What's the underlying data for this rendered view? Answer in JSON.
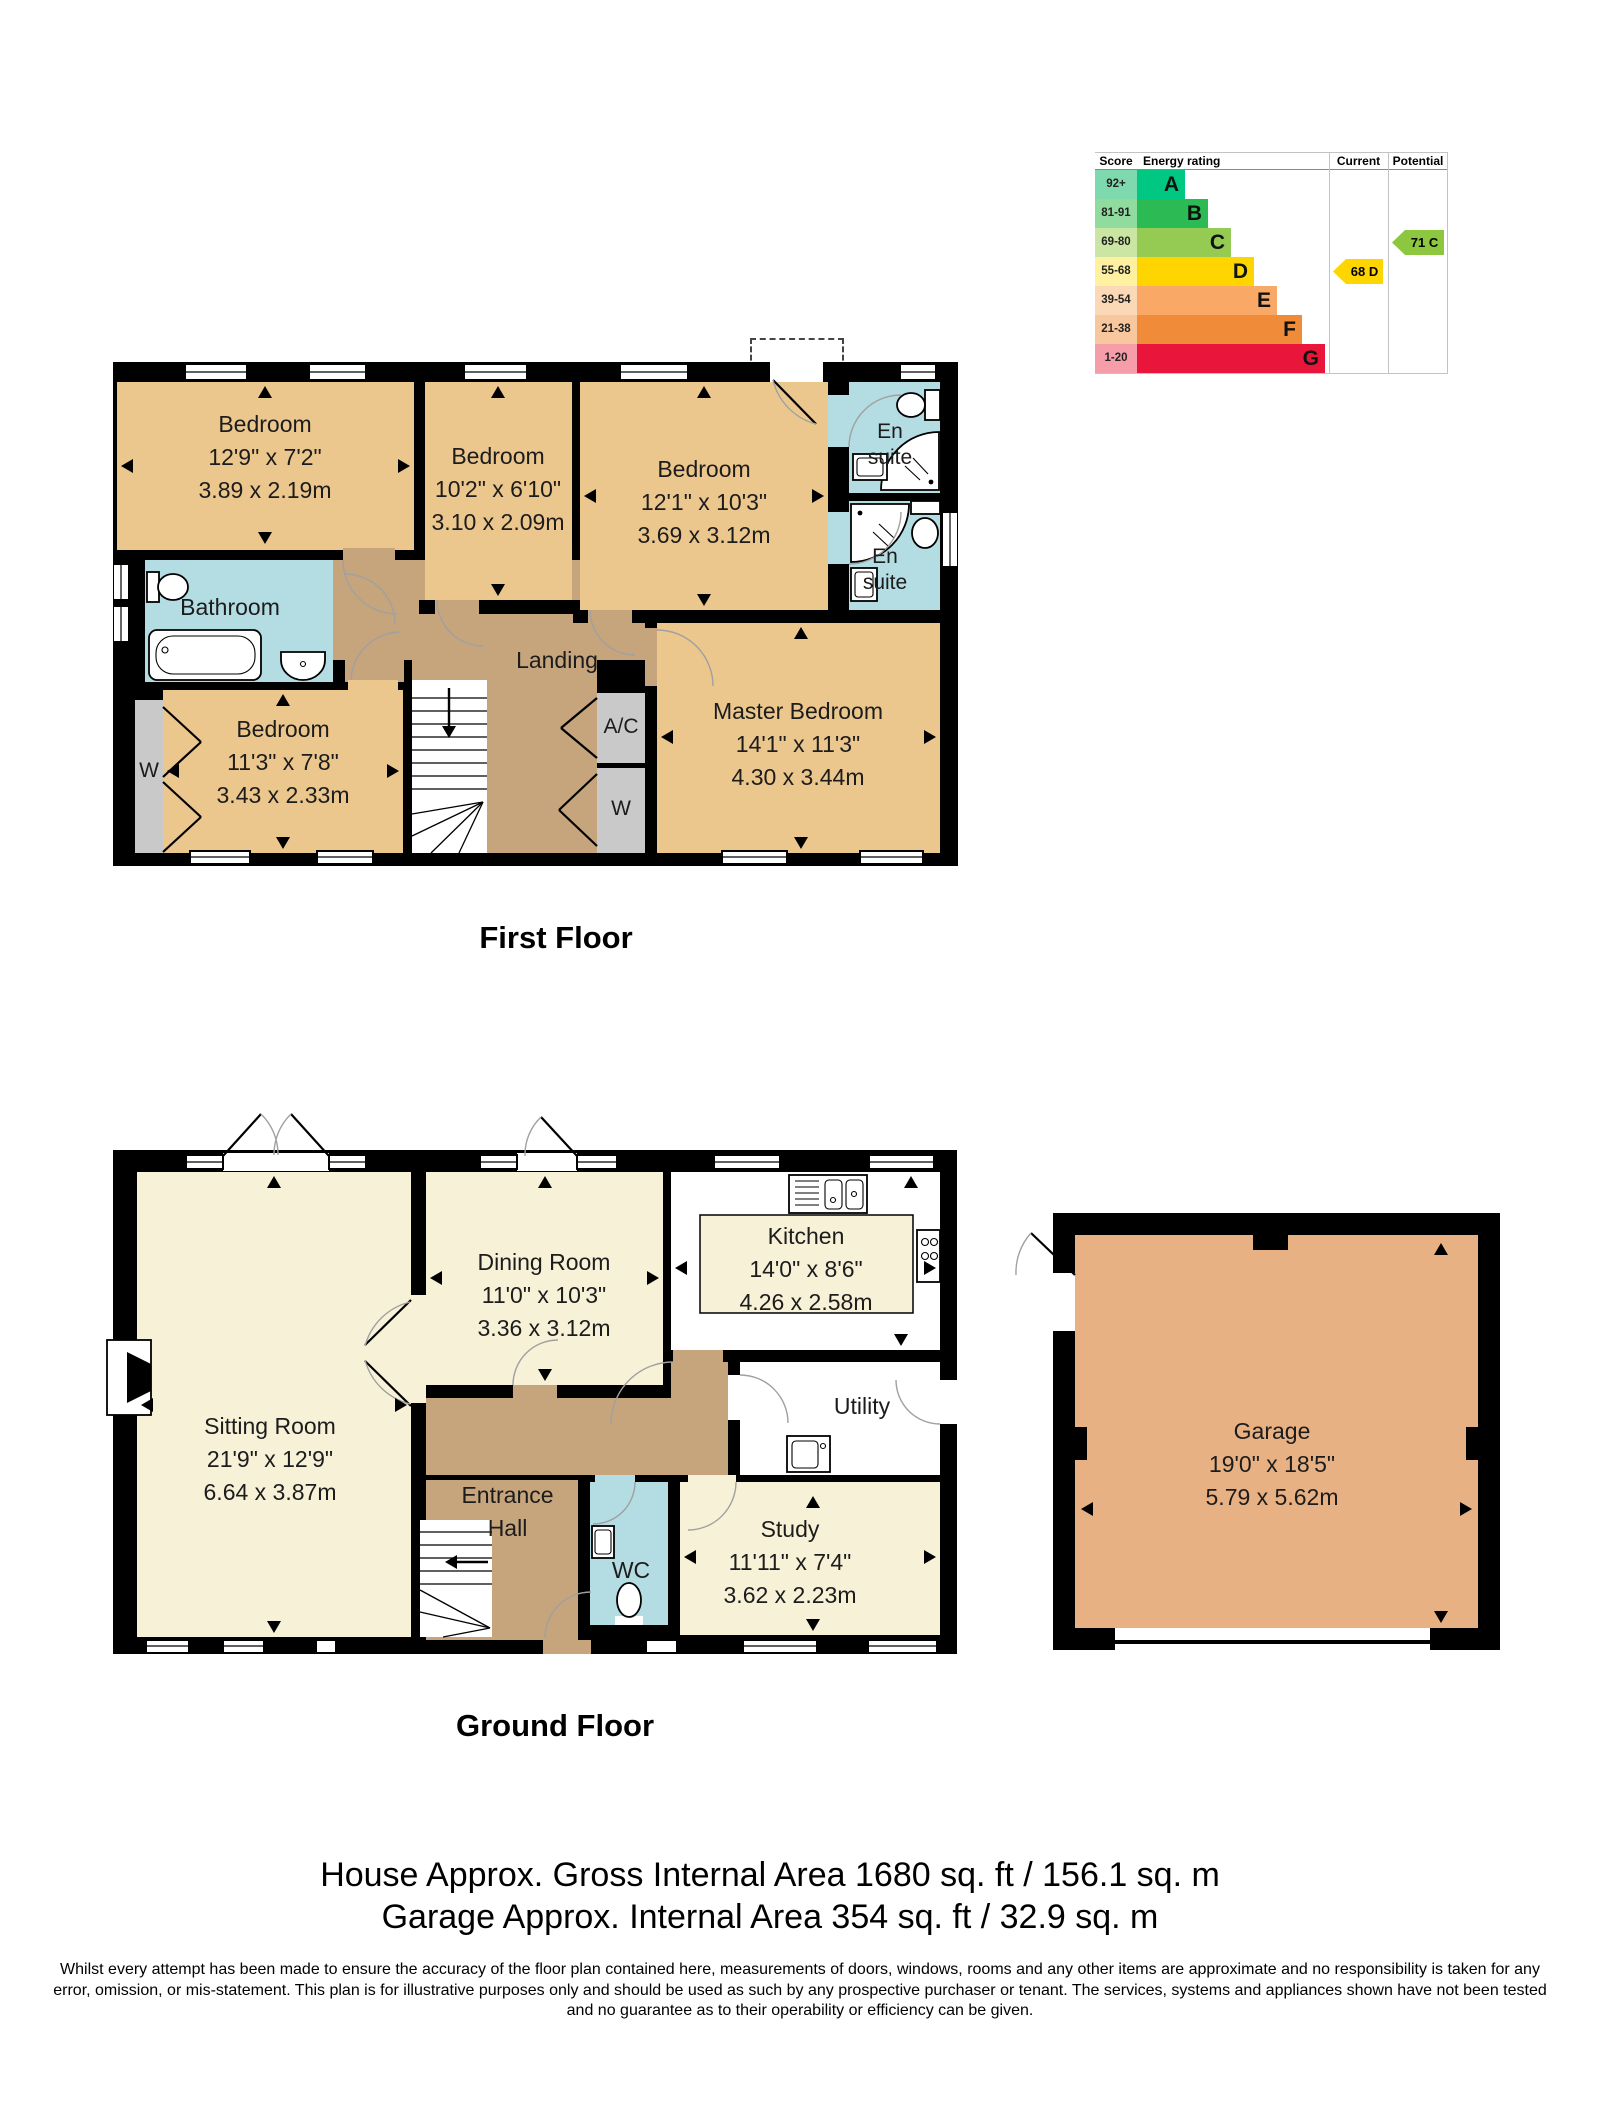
{
  "palette": {
    "wall": "#000000",
    "tan": "#ebc78e",
    "brown": "#c6a57d",
    "cream": "#f7f1d7",
    "blue": "#b4dce3",
    "gray": "#c9c9c9",
    "garage": "#e8b184"
  },
  "epc": {
    "headers": {
      "score": "Score",
      "rating": "Energy rating",
      "current": "Current",
      "potential": "Potential"
    },
    "bands": [
      {
        "score": "92+",
        "letter": "A",
        "color": "#00c781",
        "swatch": "#7fd9ae",
        "width": 48
      },
      {
        "score": "81-91",
        "letter": "B",
        "color": "#2cba54",
        "swatch": "#90db9e",
        "width": 71
      },
      {
        "score": "69-80",
        "letter": "C",
        "color": "#95ca53",
        "swatch": "#cbe6a3",
        "width": 94
      },
      {
        "score": "55-68",
        "letter": "D",
        "color": "#ffd500",
        "swatch": "#fff1a0",
        "width": 117
      },
      {
        "score": "39-54",
        "letter": "E",
        "color": "#f9a965",
        "swatch": "#fcd9b6",
        "width": 140
      },
      {
        "score": "21-38",
        "letter": "F",
        "color": "#ef8b39",
        "swatch": "#f8c79e",
        "width": 165
      },
      {
        "score": "1-20",
        "letter": "G",
        "color": "#e9153b",
        "swatch": "#f59ea9",
        "width": 188
      }
    ],
    "current": {
      "label": "68 D",
      "color": "#ffd500",
      "row": 3
    },
    "potential": {
      "label": "71 C",
      "color": "#8dc63f",
      "row": 2
    }
  },
  "first_floor": {
    "title": "First Floor",
    "rooms": {
      "bedroom1": {
        "name": "Bedroom",
        "imperial": "12'9\" x 7'2\"",
        "metric": "3.89 x 2.19m"
      },
      "bedroom2": {
        "name": "Bedroom",
        "imperial": "10'2\" x 6'10\"",
        "metric": "3.10 x 2.09m"
      },
      "bedroom3": {
        "name": "Bedroom",
        "imperial": "12'1\" x 10'3\"",
        "metric": "3.69 x 3.12m"
      },
      "ensuite1": {
        "name": "En suite"
      },
      "ensuite2": {
        "name": "En suite"
      },
      "bathroom": {
        "name": "Bathroom"
      },
      "landing": {
        "name": "Landing"
      },
      "bedroom4": {
        "name": "Bedroom",
        "imperial": "11'3\" x 7'8\"",
        "metric": "3.43 x 2.33m"
      },
      "master": {
        "name": "Master Bedroom",
        "imperial": "14'1\" x 11'3\"",
        "metric": "4.30 x 3.44m"
      },
      "ac": {
        "name": "A/C"
      },
      "wardrobe": {
        "name": "W"
      },
      "wardrobe_left": {
        "name": "W"
      }
    }
  },
  "ground_floor": {
    "title": "Ground Floor",
    "rooms": {
      "sitting": {
        "name": "Sitting Room",
        "imperial": "21'9\" x 12'9\"",
        "metric": "6.64 x 3.87m"
      },
      "dining": {
        "name": "Dining Room",
        "imperial": "11'0\" x 10'3\"",
        "metric": "3.36 x 3.12m"
      },
      "kitchen": {
        "name": "Kitchen",
        "imperial": "14'0\" x 8'6\"",
        "metric": "4.26 x 2.58m"
      },
      "utility": {
        "name": "Utility"
      },
      "hall": {
        "name": "Entrance Hall"
      },
      "wc": {
        "name": "WC"
      },
      "study": {
        "name": "Study",
        "imperial": "11'11\" x 7'4\"",
        "metric": "3.62 x 2.23m"
      }
    }
  },
  "garage": {
    "name": "Garage",
    "imperial": "19'0\" x 18'5\"",
    "metric": "5.79 x 5.62m"
  },
  "footer": {
    "line1": "House Approx. Gross Internal Area 1680 sq. ft / 156.1 sq. m",
    "line2": "Garage Approx. Internal Area 354 sq. ft / 32.9 sq. m",
    "disclaimer": "Whilst every attempt has been made to ensure the accuracy of the floor plan contained here, measurements of doors, windows, rooms and any other items are approximate and no responsibility is taken for any error, omission, or mis-statement. This plan is for illustrative purposes only and should be used as such by any prospective purchaser or tenant. The services, systems and appliances shown have not been tested and no guarantee as to their operability or efficiency can be given."
  }
}
